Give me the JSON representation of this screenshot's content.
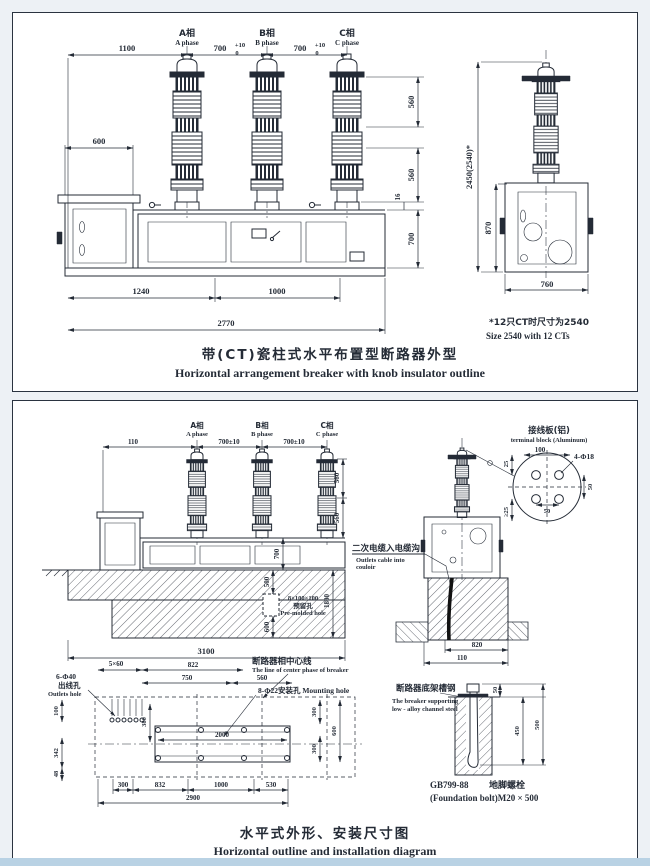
{
  "page": {
    "ink": "#242b36",
    "background": "#edf1f5",
    "paper": "#ffffff",
    "bottom_strip": "#b9d2e4"
  },
  "panel1": {
    "title_zh": "带(CT)瓷柱式水平布置型断路器外型",
    "title_en": "Horizontal arrangement breaker with knob insulator outline",
    "phase_a_zh": "A相",
    "phase_a_en": "A phase",
    "phase_b_zh": "B相",
    "phase_b_en": "B phase",
    "phase_c_zh": "C相",
    "phase_c_en": "C phase",
    "dim_1100": "1100",
    "dim_700": "700",
    "tol_plus": "+10",
    "tol_zero": "0",
    "dim_600": "600",
    "dim_560_upper": "560",
    "dim_560_lower": "560",
    "dim_16": "16",
    "dim_700_frame": "700",
    "dim_1240": "1240",
    "dim_1000": "1000",
    "dim_2770": "2770",
    "dim_total_height": "2450(2540)*",
    "dim_870": "870",
    "dim_760": "760",
    "note_zh": "*12只CT时尺寸为2540",
    "note_en": "Size 2540 with 12 CTs"
  },
  "panel2": {
    "title_zh": "水平式外形、安装尺寸图",
    "title_en": "Horizontal outline and installation diagram",
    "phase_a_zh": "A相",
    "phase_a_en": "A phase",
    "phase_b_zh": "B相",
    "phase_b_en": "B phase",
    "phase_c_zh": "C相",
    "phase_c_en": "C phase",
    "dim_110": "110",
    "dim_700pm": "700±10",
    "dim_560_upper": "560",
    "dim_560_lower": "560",
    "dim_700_frame": "700",
    "found": {
      "dim_500": "500",
      "dim_1800": "1800",
      "dim_600": "600",
      "hole_size": "8×100×100",
      "hole_zh": "预留孔",
      "hole_en": "Pre-molded hole",
      "dim_3100": "3100"
    },
    "terminal": {
      "label_zh": "接线板(铝)",
      "label_en": "terminal block (Aluminum)",
      "dim_100": "100",
      "holes": "4-Φ18",
      "dim_25": "25",
      "dim_50_right": "50",
      "dim_50_bottom": "50",
      "dim_ge25": "≥25"
    },
    "cable": {
      "label_zh": "二次电缆入电缆沟",
      "label_en1": "Outlets cable into",
      "label_en2": "couloir",
      "dim_820": "820",
      "dim_110": "110"
    },
    "plan": {
      "grid": "5×60",
      "outlets_qty": "6-Φ40",
      "outlets_zh": "出线孔",
      "outlets_en": "Outlets hole",
      "dim_822": "822",
      "dim_750": "750",
      "dim_560": "560",
      "centerline_zh": "断路器相中心线",
      "centerline_en": "The line of center phase of breaker",
      "mounting": "8-Φ22安装孔 Mounting hole",
      "dim_100": "100",
      "dim_380": "380",
      "dim_342": "342",
      "dim_48": "48",
      "dim_2000": "2000",
      "dim_300_tr": "300",
      "dim_600": "600",
      "dim_300_br": "300",
      "dim_300_b": "300",
      "dim_832": "832",
      "dim_1000": "1000",
      "dim_530": "530",
      "dim_2900": "2900"
    },
    "bolt": {
      "channel_zh": "断路器底架槽钢",
      "channel_en1": "The breaker supporting",
      "channel_en2": "low - alloy channel steel",
      "dim_50": "50",
      "dim_450": "450",
      "dim_500": "500",
      "std": "GB799-88",
      "bolt_zh": "地脚螺栓",
      "bolt_en": "(Foundation bolt)M20 × 500"
    }
  }
}
